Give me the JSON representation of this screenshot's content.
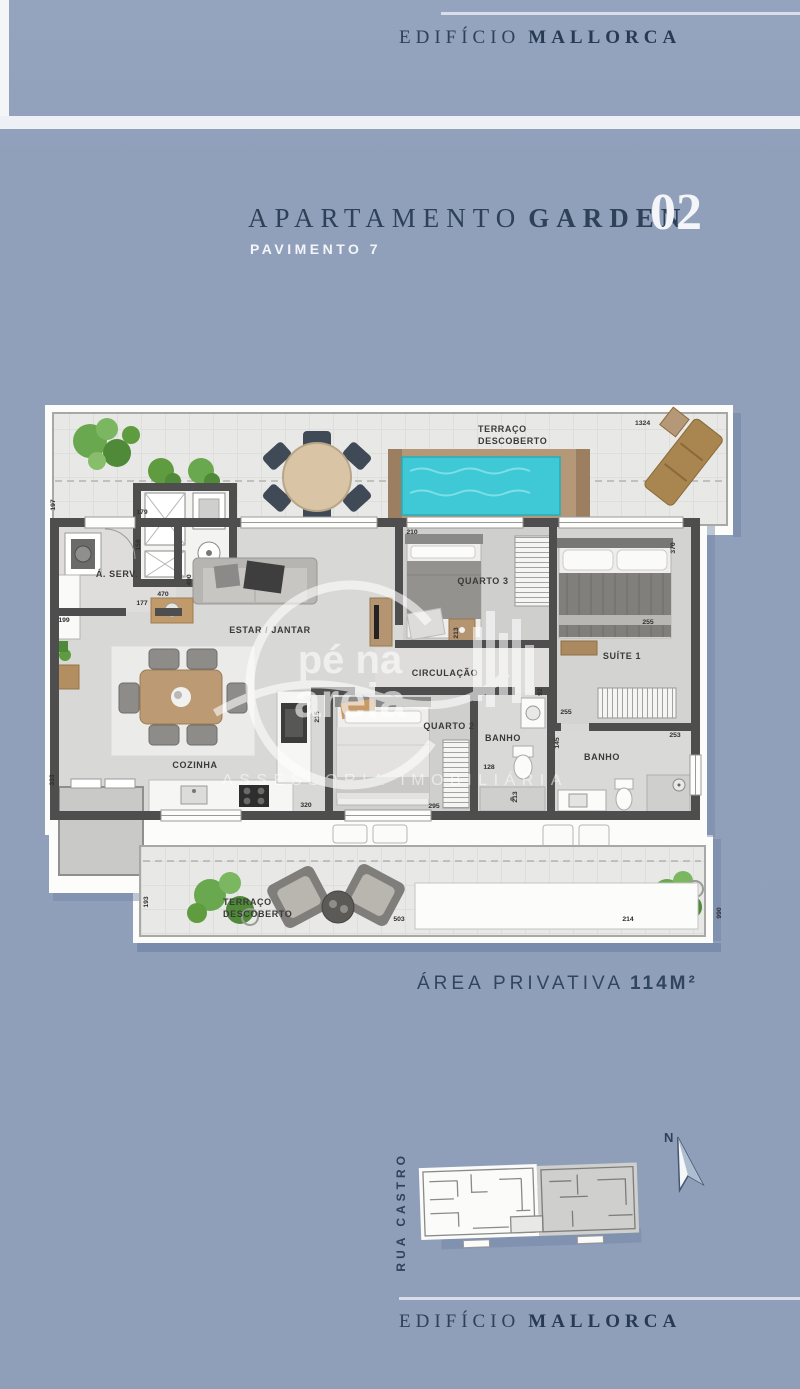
{
  "brand": {
    "light": "EDIFÍCIO",
    "bold": "MALLORCA"
  },
  "title": {
    "apartamento": "APARTAMENTO",
    "garden": "GARDEN",
    "unit": "02",
    "pavimento": "PAVIMENTO 7"
  },
  "area": {
    "label": "ÁREA PRIVATIVA",
    "value": "114M²"
  },
  "siteplan": {
    "street": "RUA CASTRO",
    "north": "N"
  },
  "watermark": {
    "line1": "pé na",
    "line2": "areia",
    "tagline": "ASSESSORIA IMOBILIÁRIA"
  },
  "floorplan": {
    "rooms": {
      "terrace_top_l1": "TERRAÇO",
      "terrace_top_l2": "DESCOBERTO",
      "aserv": "Á. SERV.",
      "estar_jantar": "ESTAR / JANTAR",
      "quarto3": "QUARTO 3",
      "suite1": "SUÍTE 1",
      "circulacao": "CIRCULAÇÃO",
      "cozinha": "COZINHA",
      "quarto2": "QUARTO 2",
      "banho_meio": "BANHO",
      "banho_suite": "BANHO",
      "terrace_bottom_l1": "TERRAÇO",
      "terrace_bottom_l2": "DESCOBERTO"
    },
    "dims": {
      "terrace_top": "1324",
      "left_top": "197",
      "aserv_top": "179",
      "aserv_right": "158",
      "aserv_bottom": "177",
      "estar_table": "470",
      "estar_depth": "490",
      "cozinha_left_top": "199",
      "cozinha_left": "333",
      "cozinha_bottom": "320",
      "quarto3_top": "210",
      "quarto3_wall": "213",
      "suite_right": "370",
      "suite_closet": "255",
      "circ_end": "92",
      "quarto2_left": "215",
      "quarto2_bottom": "295",
      "banho_meio_width": "128",
      "banho_meio_side": "213",
      "banho_suite_top": "255",
      "banho_suite_left": "145",
      "banho_suite_width": "253",
      "terrace_bottom_left": "193",
      "terrace_bottom_width": "503",
      "terrace_bottom_right": "214",
      "terrace_bottom_side": "990"
    }
  }
}
